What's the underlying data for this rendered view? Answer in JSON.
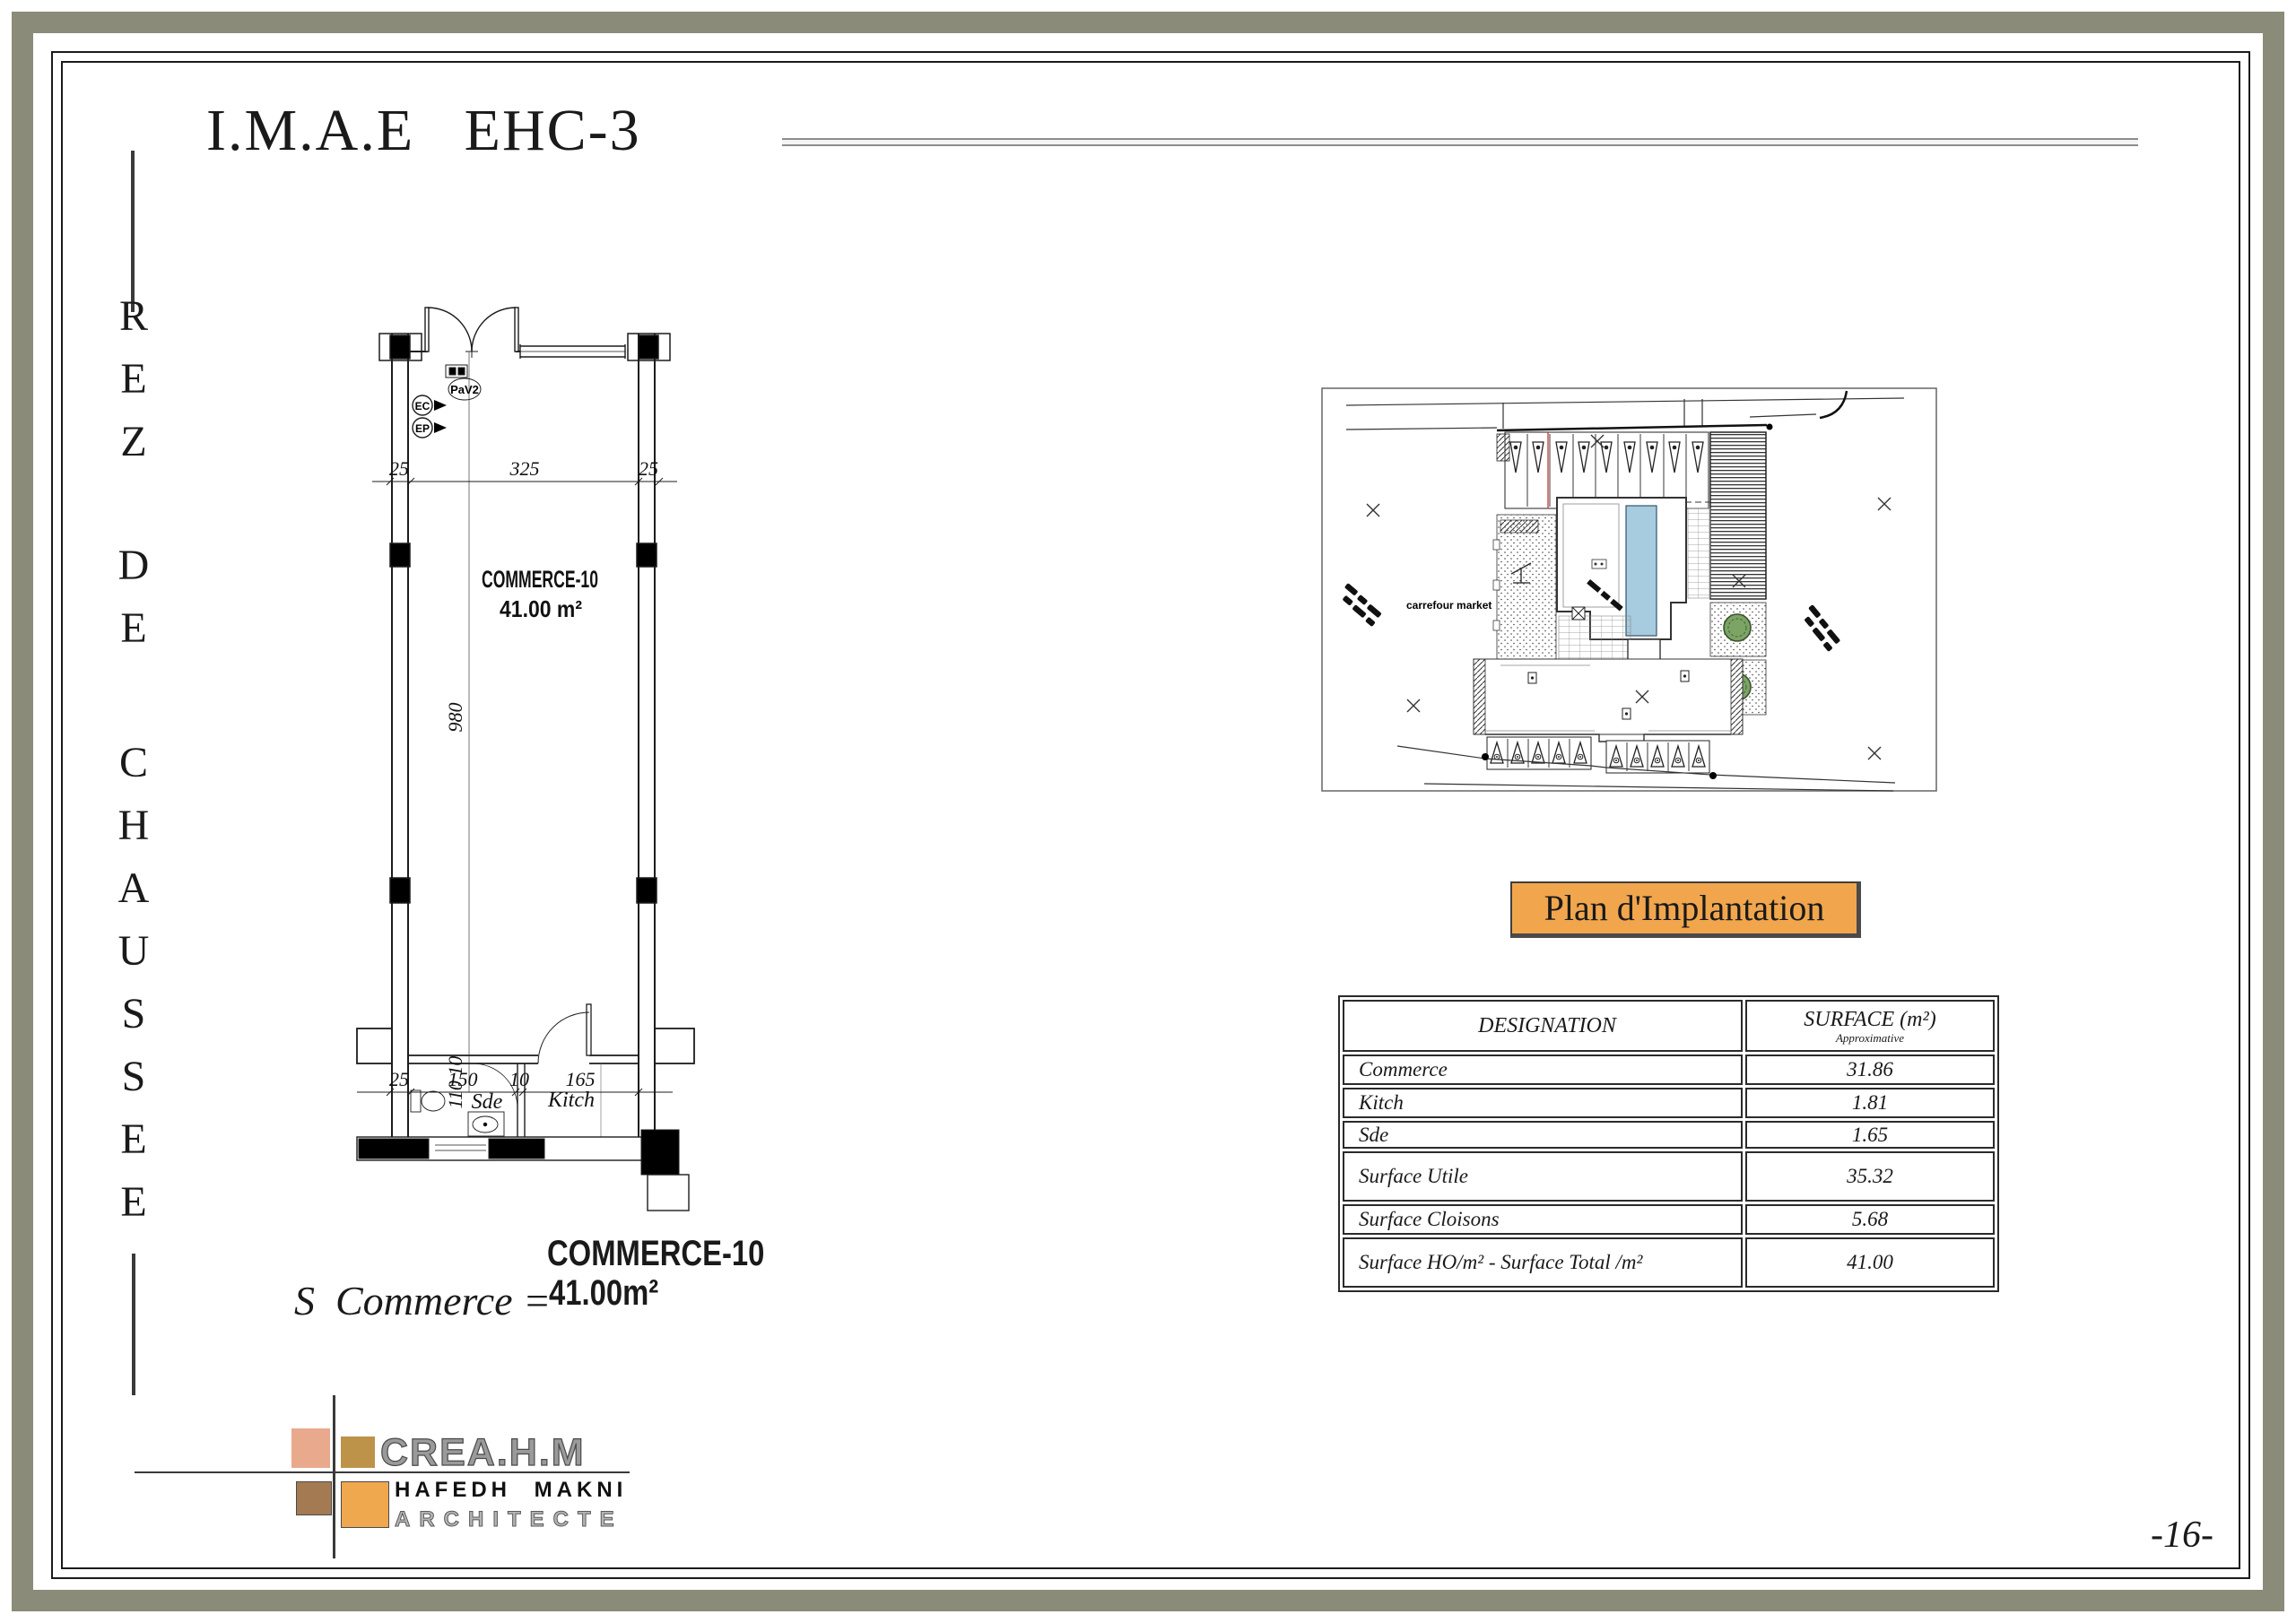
{
  "title": "I.M.A.E   EHC-3",
  "side": {
    "letters": [
      "R",
      "E",
      "Z",
      "D",
      "E",
      "C",
      "H",
      "A",
      "U",
      "S",
      "S",
      "E",
      "E"
    ]
  },
  "floor_plan": {
    "dims": {
      "top_left": "25",
      "top_mid": "325",
      "top_right": "25",
      "height": "980",
      "bottom_1": "25",
      "bottom_2": "150",
      "bottom_3": "10",
      "bottom_4": "165",
      "side": "110 10"
    },
    "labels": {
      "room": "COMMERCE-10",
      "area": "41.00 m²",
      "sde": "Sde",
      "kitch": "Kitch",
      "pav": "PaV2",
      "ec": "EC",
      "ep": "EP"
    }
  },
  "caption": {
    "formula": "S  Commerce =",
    "name": "COMMERCE-10",
    "area": "41.00m²"
  },
  "site_plan": {
    "badge": "Plan d'Implantation",
    "store_label": "carrefour market"
  },
  "surface_table": {
    "col1_header": "DESIGNATION",
    "col2_header": "SURFACE (m²)",
    "col2_subheader": "Approximative",
    "rows": [
      {
        "designation": "Commerce",
        "surface": "31.86"
      },
      {
        "designation": "Kitch",
        "surface": "1.81"
      },
      {
        "designation": "Sde",
        "surface": "1.65"
      },
      {
        "designation": "Surface Utile",
        "surface": "35.32"
      },
      {
        "designation": "Surface Cloisons",
        "surface": "5.68"
      },
      {
        "designation": "Surface HO/m² - Surface Total /m²",
        "surface": "41.00"
      }
    ]
  },
  "logo": {
    "brand": "CREA.H.M",
    "architect": "HAFEDH MAKNI",
    "profession": "ARCHITECTE"
  },
  "page_number": "-16-",
  "colors": {
    "accent_orange": "#f1a64d",
    "pool_blue": "#a7cbdf",
    "olive_border": "#8b8b79",
    "logo_salmon": "#e9a98c",
    "logo_gold": "#bd9349",
    "logo_brown": "#a47a52",
    "logo_orange": "#f0a84f"
  }
}
